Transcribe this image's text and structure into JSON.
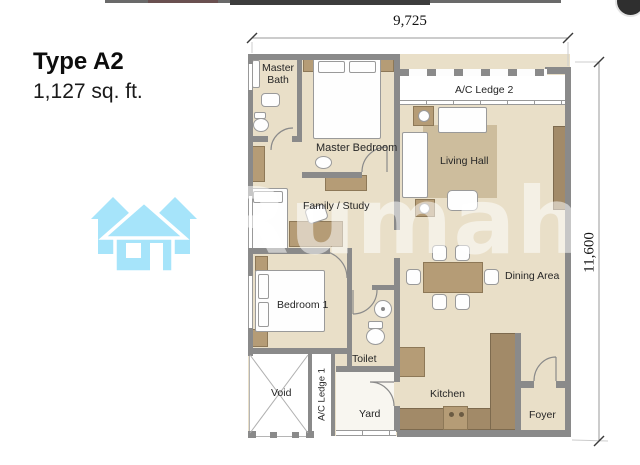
{
  "title_block": {
    "type_label": "Type A2",
    "area_label": "1,127 sq. ft."
  },
  "dimensions": {
    "top": "9,725",
    "right": "11,600"
  },
  "rooms": {
    "master_bath": {
      "label": "Master Bath"
    },
    "master_bedroom": {
      "label": "Master Bedroom"
    },
    "ac_ledge_2": {
      "label": "A/C Ledge 2"
    },
    "living_hall": {
      "label": "Living Hall"
    },
    "family_study": {
      "label": "Family / Study"
    },
    "dining_area": {
      "label": "Dining Area"
    },
    "bedroom_1": {
      "label": "Bedroom 1"
    },
    "toilet": {
      "label": "Toilet"
    },
    "kitchen": {
      "label": "Kitchen"
    },
    "yard": {
      "label": "Yard"
    },
    "ac_ledge_1": {
      "label": "A/C Ledge 1"
    },
    "void": {
      "label": "Void"
    },
    "foyer": {
      "label": "Foyer"
    }
  },
  "watermark": {
    "text": "Rumah"
  },
  "logo": {
    "name": "rumah-triple-house-logo",
    "color": "#a6e4fa"
  },
  "palette": {
    "floor_beige": "#e9dfc8",
    "wall_gray": "#8a8a8a",
    "furniture_tan": "#b59c76",
    "counter_tan": "#a28a68",
    "rug_tan": "#cdbd9d",
    "logo_blue": "#a6e4fa"
  }
}
